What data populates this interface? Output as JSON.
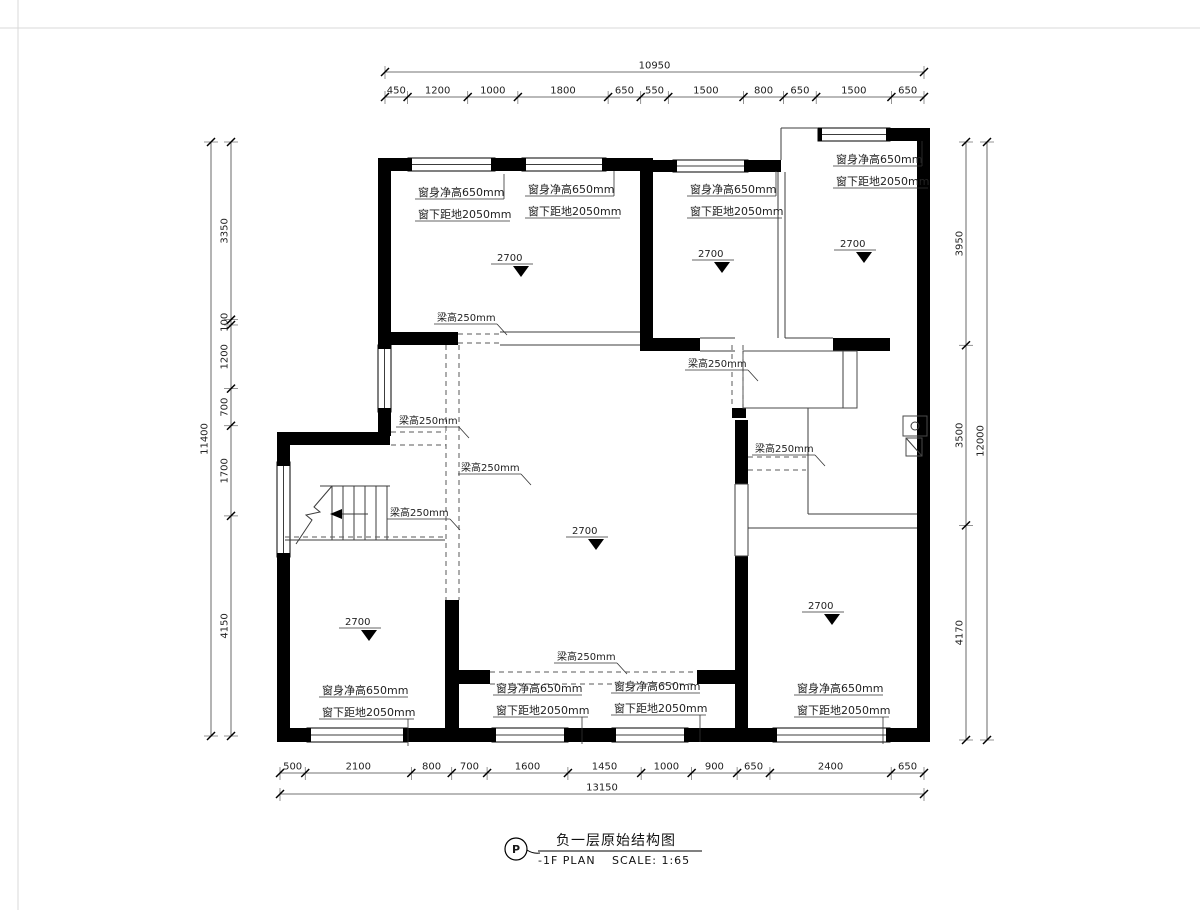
{
  "title_block": {
    "badge": "P",
    "title_zh": "负一层原始结构图",
    "subtitle_en": "-1F PLAN",
    "scale": "SCALE: 1:65"
  },
  "labels": {
    "window_height": "窗身净高650mm",
    "window_sill": "窗下距地2050mm",
    "beam_height": "梁高250mm",
    "ceiling_height": "2700"
  },
  "annotations": {
    "window_labels": [
      {
        "x": 418,
        "y": 196,
        "dir": "up"
      },
      {
        "x": 528,
        "y": 193,
        "dir": "up"
      },
      {
        "x": 690,
        "y": 193,
        "dir": "up"
      },
      {
        "x": 836,
        "y": 163,
        "dir": "up"
      },
      {
        "x": 322,
        "y": 694,
        "dir": "down"
      },
      {
        "x": 496,
        "y": 692,
        "dir": "down"
      },
      {
        "x": 614,
        "y": 690,
        "dir": "down"
      },
      {
        "x": 797,
        "y": 692,
        "dir": "down"
      }
    ],
    "beam_labels": [
      {
        "x": 437,
        "y": 321
      },
      {
        "x": 399,
        "y": 424
      },
      {
        "x": 461,
        "y": 471
      },
      {
        "x": 390,
        "y": 516
      },
      {
        "x": 688,
        "y": 367
      },
      {
        "x": 755,
        "y": 452
      },
      {
        "x": 557,
        "y": 660
      }
    ],
    "ceiling_markers": [
      {
        "x": 497,
        "y": 261
      },
      {
        "x": 698,
        "y": 257
      },
      {
        "x": 840,
        "y": 247
      },
      {
        "x": 572,
        "y": 534
      },
      {
        "x": 345,
        "y": 625
      },
      {
        "x": 808,
        "y": 609
      }
    ]
  },
  "dimensions": {
    "top": {
      "total": "10950",
      "segments": [
        "450",
        "1200",
        "1000",
        "1800",
        "650",
        "550",
        "1500",
        "800",
        "650",
        "1500",
        "650"
      ]
    },
    "bottom": {
      "total": "13150",
      "segments": [
        "500",
        "2100",
        "800",
        "700",
        "1600",
        "1450",
        "1000",
        "900",
        "650",
        "2400",
        "650"
      ]
    },
    "left": {
      "total": "11400",
      "segments": [
        "3350",
        "100",
        "1200",
        "700",
        "1700",
        "4150"
      ]
    },
    "right": {
      "total": "12000",
      "segments": [
        "3950",
        "3500",
        "4170"
      ]
    }
  }
}
